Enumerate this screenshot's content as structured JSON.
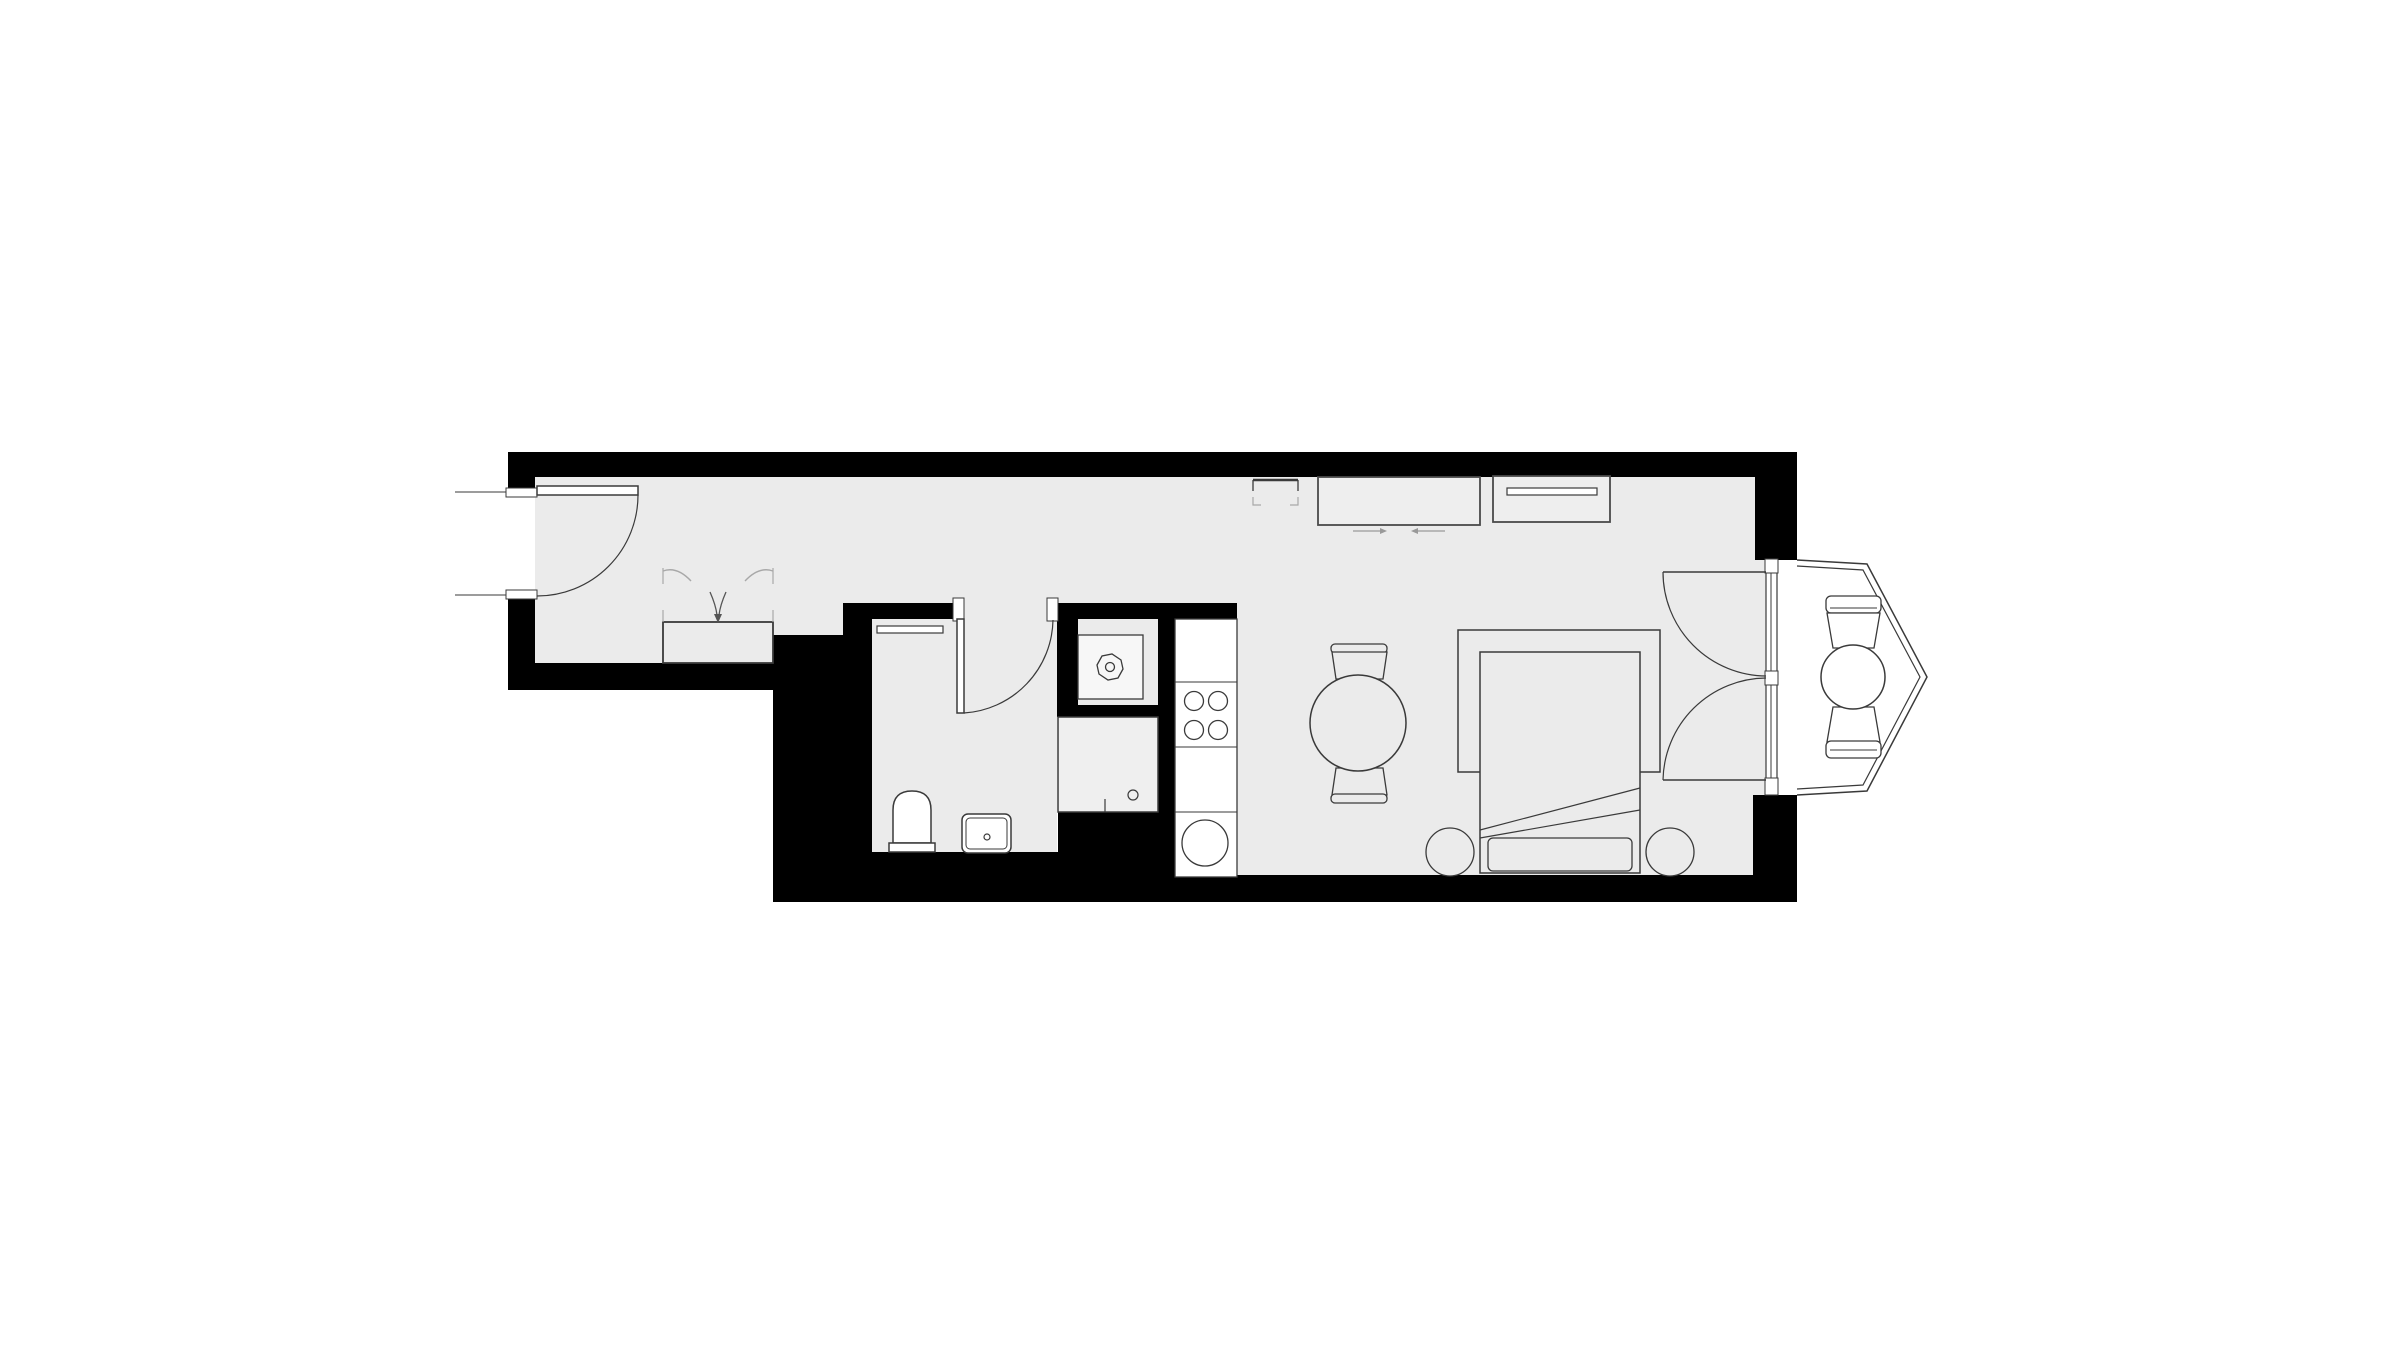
{
  "meta": {
    "title": "apartment-floor-plan",
    "canvas_width": 2400,
    "canvas_height": 1349
  },
  "palette": {
    "background": "#ffffff",
    "floor": "#ebebeb",
    "wall": "#000000",
    "outline": "#3a3a3a",
    "soft": "#555555",
    "light": "#a8a8a8",
    "arrow": "#999999",
    "white": "#ffffff"
  },
  "shapes": [
    {
      "name": "floor-hall-living",
      "type": "polygon",
      "points": "535,477 1755,477 1755,560 1766,560 1766,795 1753,795 1753,875 1237,875 1237,603 843,603 843,635 773,635 773,663 535,663",
      "fill": "floor"
    },
    {
      "name": "floor-bathroom",
      "type": "rect",
      "x": 872,
      "y": 603,
      "w": 185,
      "h": 249,
      "fill": "floor"
    },
    {
      "name": "floor-shower-niche",
      "type": "rect",
      "x": 1078,
      "y": 619,
      "w": 80,
      "h": 86,
      "fill": "floor"
    },
    {
      "name": "floor-bay-balcony",
      "type": "polygon",
      "points": "1776,560 1797,560 1867,564 1927,677 1867,791 1797,795 1776,795",
      "fill": "white"
    },
    {
      "name": "wall-top",
      "type": "rect",
      "x": 508,
      "y": 452,
      "w": 1289,
      "h": 25,
      "fill": "wall"
    },
    {
      "name": "wall-top-right-corner",
      "type": "rect",
      "x": 1755,
      "y": 452,
      "w": 42,
      "h": 108,
      "fill": "wall"
    },
    {
      "name": "wall-left-upper",
      "type": "rect",
      "x": 508,
      "y": 452,
      "w": 27,
      "h": 41,
      "fill": "wall"
    },
    {
      "name": "wall-left-lower",
      "type": "rect",
      "x": 508,
      "y": 597,
      "w": 27,
      "h": 93,
      "fill": "wall"
    },
    {
      "name": "wall-hall-bottom",
      "type": "rect",
      "x": 508,
      "y": 663,
      "w": 265,
      "h": 27,
      "fill": "wall"
    },
    {
      "name": "wall-block-left-of-bath",
      "type": "rect",
      "x": 773,
      "y": 635,
      "w": 70,
      "h": 267,
      "fill": "wall"
    },
    {
      "name": "wall-bath-left",
      "type": "rect",
      "x": 843,
      "y": 603,
      "w": 29,
      "h": 249,
      "fill": "wall"
    },
    {
      "name": "wall-bath-top-left",
      "type": "rect",
      "x": 843,
      "y": 603,
      "w": 113,
      "h": 16,
      "fill": "wall"
    },
    {
      "name": "wall-bath-top-right",
      "type": "rect",
      "x": 1056,
      "y": 603,
      "w": 181,
      "h": 16,
      "fill": "wall"
    },
    {
      "name": "wall-shower-left",
      "type": "rect",
      "x": 1057,
      "y": 619,
      "w": 21,
      "h": 86,
      "fill": "wall"
    },
    {
      "name": "wall-shower-stub",
      "type": "rect",
      "x": 1057,
      "y": 705,
      "w": 101,
      "h": 12,
      "fill": "wall"
    },
    {
      "name": "wall-divider-kitchen",
      "type": "rect",
      "x": 1158,
      "y": 603,
      "w": 17,
      "h": 299,
      "fill": "wall"
    },
    {
      "name": "wall-bath-bottom",
      "type": "rect",
      "x": 843,
      "y": 852,
      "w": 332,
      "h": 50,
      "fill": "wall"
    },
    {
      "name": "wall-below-washing",
      "type": "rect",
      "x": 1058,
      "y": 812,
      "w": 100,
      "h": 40,
      "fill": "wall"
    },
    {
      "name": "wall-bottom",
      "type": "rect",
      "x": 1175,
      "y": 875,
      "w": 578,
      "h": 27,
      "fill": "wall"
    },
    {
      "name": "wall-right-column",
      "type": "rect",
      "x": 1753,
      "y": 795,
      "w": 44,
      "h": 107,
      "fill": "wall"
    },
    {
      "name": "entrance-jamb-top",
      "type": "rect",
      "x": 506,
      "y": 488,
      "w": 31,
      "h": 9,
      "fill": "white",
      "stroke": "outline",
      "sw": 1
    },
    {
      "name": "entrance-jamb-bottom",
      "type": "rect",
      "x": 506,
      "y": 590,
      "w": 31,
      "h": 9,
      "fill": "white",
      "stroke": "outline",
      "sw": 1
    },
    {
      "name": "entrance-threshold-top",
      "type": "line",
      "x1": 455,
      "y1": 492,
      "x2": 506,
      "y2": 492,
      "stroke": "outline",
      "sw": 1
    },
    {
      "name": "entrance-threshold-bottom",
      "type": "line",
      "x1": 455,
      "y1": 595,
      "x2": 506,
      "y2": 595,
      "stroke": "outline",
      "sw": 1
    },
    {
      "name": "bathroom-jamb-left",
      "type": "rect",
      "x": 953,
      "y": 598,
      "w": 11,
      "h": 23,
      "fill": "white",
      "stroke": "outline",
      "sw": 1
    },
    {
      "name": "bathroom-jamb-right",
      "type": "rect",
      "x": 1047,
      "y": 598,
      "w": 11,
      "h": 23,
      "fill": "white",
      "stroke": "outline",
      "sw": 1
    },
    {
      "name": "window-wall",
      "type": "rect",
      "x": 1766,
      "y": 559,
      "w": 11,
      "h": 236,
      "fill": "white",
      "stroke": "outline",
      "sw": 1.2
    },
    {
      "name": "window-jamb-top",
      "type": "rect",
      "x": 1765,
      "y": 559,
      "w": 13,
      "h": 14,
      "fill": "white",
      "stroke": "outline",
      "sw": 1
    },
    {
      "name": "window-jamb-mid",
      "type": "rect",
      "x": 1765,
      "y": 671,
      "w": 13,
      "h": 14,
      "fill": "white",
      "stroke": "outline",
      "sw": 1
    },
    {
      "name": "window-jamb-bottom",
      "type": "rect",
      "x": 1765,
      "y": 778,
      "w": 13,
      "h": 17,
      "fill": "white",
      "stroke": "outline",
      "sw": 1
    },
    {
      "name": "glazing-upper",
      "type": "line",
      "x1": 1771,
      "y1": 573,
      "x2": 1771,
      "y2": 671,
      "stroke": "outline",
      "sw": 1
    },
    {
      "name": "glazing-lower",
      "type": "line",
      "x1": 1771,
      "y1": 685,
      "x2": 1771,
      "y2": 778,
      "stroke": "outline",
      "sw": 1
    },
    {
      "name": "bay-window-outer",
      "type": "path",
      "d": "M 1797,560 L 1867,564 L 1927,677 L 1867,791 L 1797,795",
      "stroke": "outline",
      "sw": 1.5
    },
    {
      "name": "bay-window-inner",
      "type": "path",
      "d": "M 1797,566 L 1863,570 L 1920,677 L 1863,785 L 1797,789",
      "stroke": "outline",
      "sw": 1.2
    },
    {
      "name": "entrance-door-leaf",
      "type": "rect",
      "x": 537,
      "y": 486,
      "w": 101,
      "h": 9,
      "fill": "white",
      "stroke": "outline",
      "sw": 1.5
    },
    {
      "name": "entrance-door-swing-arc",
      "type": "path",
      "d": "M 638,495 A 101,101 0 0 1 537,596",
      "stroke": "outline",
      "sw": 1.2
    },
    {
      "name": "bathroom-door-leaf",
      "type": "rect",
      "x": 957,
      "y": 619,
      "w": 7,
      "h": 94,
      "fill": "white",
      "stroke": "outline",
      "sw": 1.5
    },
    {
      "name": "bathroom-door-swing-arc",
      "type": "path",
      "d": "M 964,713 A 95,95 0 0 0 1053,620",
      "stroke": "outline",
      "sw": 1.2
    },
    {
      "name": "french-door-upper-leaf",
      "type": "line",
      "x1": 1663,
      "y1": 572,
      "x2": 1766,
      "y2": 572,
      "stroke": "outline",
      "sw": 1.5
    },
    {
      "name": "french-door-upper-arc",
      "type": "path",
      "d": "M 1663,572 A 104,104 0 0 0 1766,676",
      "stroke": "outline",
      "sw": 1.2
    },
    {
      "name": "french-door-lower-leaf",
      "type": "line",
      "x1": 1663,
      "y1": 780,
      "x2": 1766,
      "y2": 780,
      "stroke": "outline",
      "sw": 1.5
    },
    {
      "name": "french-door-lower-arc",
      "type": "path",
      "d": "M 1663,780 A 104,104 0 0 1 1766,678",
      "stroke": "outline",
      "sw": 1.2
    },
    {
      "name": "wardrobe",
      "type": "rect",
      "x": 663,
      "y": 622,
      "w": 110,
      "h": 41,
      "fill": "floor",
      "stroke": "outline",
      "sw": 1.8
    },
    {
      "name": "wardrobe-tick-left-upper",
      "type": "line",
      "x1": 663,
      "y1": 568,
      "x2": 663,
      "y2": 584,
      "stroke": "light",
      "sw": 1.2
    },
    {
      "name": "wardrobe-tick-right-upper",
      "type": "line",
      "x1": 773,
      "y1": 568,
      "x2": 773,
      "y2": 584,
      "stroke": "light",
      "sw": 1.2
    },
    {
      "name": "wardrobe-door-arc-left",
      "type": "path",
      "d": "M 663,571 Q 677,566 691,581",
      "stroke": "light",
      "sw": 1.4
    },
    {
      "name": "wardrobe-door-arc-right",
      "type": "path",
      "d": "M 773,571 Q 759,566 745,581",
      "stroke": "light",
      "sw": 1.4
    },
    {
      "name": "wardrobe-tick-left-lower",
      "type": "line",
      "x1": 663,
      "y1": 610,
      "x2": 663,
      "y2": 622,
      "stroke": "light",
      "sw": 1.2
    },
    {
      "name": "wardrobe-tick-right-lower",
      "type": "line",
      "x1": 773,
      "y1": 610,
      "x2": 773,
      "y2": 622,
      "stroke": "light",
      "sw": 1.2
    },
    {
      "name": "wardrobe-entry-arrow",
      "type": "path",
      "d": "M 710,592 C 714,601 716,607 717,615 M 726,592 C 722,601 720,607 719,615",
      "stroke": "soft",
      "sw": 1.3
    },
    {
      "name": "wardrobe-entry-arrowhead",
      "type": "polygon",
      "points": "714,614 722,614 718,623",
      "fill": "soft"
    },
    {
      "name": "bath-shelf",
      "type": "rect",
      "x": 877,
      "y": 626,
      "w": 66,
      "h": 7,
      "fill": "white",
      "stroke": "outline",
      "sw": 1.2
    },
    {
      "name": "toilet-bowl",
      "type": "path",
      "d": "M 893,843 L 893,810 Q 893,791 912,791 Q 931,791 931,810 L 931,843 Z",
      "fill": "white",
      "stroke": "outline",
      "sw": 1.5
    },
    {
      "name": "toilet-tank",
      "type": "rect",
      "x": 889,
      "y": 843,
      "w": 46,
      "h": 9,
      "fill": "white",
      "stroke": "outline",
      "sw": 1.5
    },
    {
      "name": "washbasin-outer",
      "type": "rect",
      "x": 962,
      "y": 814,
      "w": 49,
      "h": 39,
      "rx": 6,
      "fill": "white",
      "stroke": "outline",
      "sw": 1.5
    },
    {
      "name": "washbasin-inner",
      "type": "rect",
      "x": 966,
      "y": 818,
      "w": 41,
      "h": 31,
      "rx": 4,
      "stroke": "outline",
      "sw": 1
    },
    {
      "name": "washbasin-drain",
      "type": "circle",
      "cx": 987,
      "cy": 837,
      "r": 3,
      "stroke": "outline",
      "sw": 1.2
    },
    {
      "name": "shower-tray",
      "type": "rect",
      "x": 1078,
      "y": 635,
      "w": 65,
      "h": 64,
      "fill": "#f7f7f7",
      "stroke": "outline",
      "sw": 1.3
    },
    {
      "name": "shower-head-octagon",
      "type": "polygon",
      "points": "1123,669 1118,678 1108,680 1099,674 1097,665 1102,656 1112,654 1121,660",
      "stroke": "outline",
      "sw": 1.3
    },
    {
      "name": "shower-head-center",
      "type": "circle",
      "cx": 1110,
      "cy": 667,
      "r": 4.5,
      "stroke": "outline",
      "sw": 1.3
    },
    {
      "name": "washing-machine",
      "type": "rect",
      "x": 1058,
      "y": 717,
      "w": 100,
      "h": 95,
      "fill": "#efefef",
      "stroke": "outline",
      "sw": 1.5
    },
    {
      "name": "washing-machine-knob",
      "type": "circle",
      "cx": 1133,
      "cy": 795,
      "r": 5,
      "stroke": "outline",
      "sw": 1.2
    },
    {
      "name": "washing-machine-tick",
      "type": "line",
      "x1": 1105,
      "y1": 799,
      "x2": 1105,
      "y2": 812,
      "stroke": "outline",
      "sw": 1.2
    },
    {
      "name": "kitchen-counter",
      "type": "rect",
      "x": 1175,
      "y": 619,
      "w": 62,
      "h": 258,
      "fill": "white",
      "stroke": "outline",
      "sw": 1.3
    },
    {
      "name": "counter-divider-1",
      "type": "line",
      "x1": 1175,
      "y1": 682,
      "x2": 1237,
      "y2": 682,
      "stroke": "outline",
      "sw": 1
    },
    {
      "name": "counter-divider-2",
      "type": "line",
      "x1": 1175,
      "y1": 747,
      "x2": 1237,
      "y2": 747,
      "stroke": "outline",
      "sw": 1
    },
    {
      "name": "counter-divider-3",
      "type": "line",
      "x1": 1175,
      "y1": 812,
      "x2": 1237,
      "y2": 812,
      "stroke": "outline",
      "sw": 1
    },
    {
      "name": "stove-burner-1",
      "type": "circle",
      "cx": 1194,
      "cy": 701,
      "r": 9.5,
      "stroke": "outline",
      "sw": 1.3
    },
    {
      "name": "stove-burner-2",
      "type": "circle",
      "cx": 1218,
      "cy": 701,
      "r": 9.5,
      "stroke": "outline",
      "sw": 1.3
    },
    {
      "name": "stove-burner-3",
      "type": "circle",
      "cx": 1194,
      "cy": 730,
      "r": 9.5,
      "stroke": "outline",
      "sw": 1.3
    },
    {
      "name": "stove-burner-4",
      "type": "circle",
      "cx": 1218,
      "cy": 730,
      "r": 9.5,
      "stroke": "outline",
      "sw": 1.3
    },
    {
      "name": "kitchen-sink",
      "type": "circle",
      "cx": 1205,
      "cy": 843,
      "r": 23,
      "stroke": "outline",
      "sw": 1.3
    },
    {
      "name": "corner-unit-top",
      "type": "line",
      "x1": 1253,
      "y1": 480,
      "x2": 1298,
      "y2": 480,
      "stroke": "outline",
      "sw": 2.5
    },
    {
      "name": "corner-unit-left",
      "type": "line",
      "x1": 1253,
      "y1": 480,
      "x2": 1253,
      "y2": 491,
      "stroke": "outline",
      "sw": 1.3
    },
    {
      "name": "corner-unit-right",
      "type": "line",
      "x1": 1298,
      "y1": 480,
      "x2": 1298,
      "y2": 491,
      "stroke": "outline",
      "sw": 1.3
    },
    {
      "name": "corner-unit-dash-left",
      "type": "path",
      "d": "M 1253,497 L 1253,505 L 1261,505",
      "stroke": "light",
      "sw": 1.2
    },
    {
      "name": "corner-unit-dash-right",
      "type": "path",
      "d": "M 1290,505 L 1298,505 L 1298,497",
      "stroke": "light",
      "sw": 1.2
    },
    {
      "name": "sideboard",
      "type": "rect",
      "x": 1318,
      "y": 477,
      "w": 162,
      "h": 48,
      "fill": "#eeeeee",
      "stroke": "#4a4a4a",
      "sw": 1.8
    },
    {
      "name": "sliding-arrow-right",
      "type": "line",
      "x1": 1353,
      "y1": 531,
      "x2": 1380,
      "y2": 531,
      "stroke": "arrow",
      "sw": 1.3
    },
    {
      "name": "sliding-arrow-right-head",
      "type": "polygon",
      "points": "1380,528 1387,531 1380,534",
      "fill": "arrow"
    },
    {
      "name": "sliding-arrow-left",
      "type": "line",
      "x1": 1418,
      "y1": 531,
      "x2": 1445,
      "y2": 531,
      "stroke": "arrow",
      "sw": 1.3
    },
    {
      "name": "sliding-arrow-left-head",
      "type": "polygon",
      "points": "1418,528 1411,531 1418,534",
      "fill": "arrow"
    },
    {
      "name": "tv-stand",
      "type": "rect",
      "x": 1493,
      "y": 476,
      "w": 117,
      "h": 46,
      "fill": "#eeeeee",
      "stroke": "#4a4a4a",
      "sw": 1.8
    },
    {
      "name": "tv",
      "type": "rect",
      "x": 1507,
      "y": 488,
      "w": 90,
      "h": 7,
      "fill": "white",
      "stroke": "outline",
      "sw": 1.2
    },
    {
      "name": "dining-chair-top-backrest",
      "type": "rect",
      "x": 1331,
      "y": 644,
      "w": 56,
      "h": 9,
      "rx": 4,
      "fill": "floor",
      "stroke": "outline",
      "sw": 1.3
    },
    {
      "name": "dining-chair-top-seat",
      "type": "polygon",
      "points": "1332,652 1387,652 1383,679 1336,679",
      "fill": "floor",
      "stroke": "outline",
      "sw": 1.3
    },
    {
      "name": "dining-chair-bottom-seat",
      "type": "polygon",
      "points": "1336,768 1383,768 1387,795 1332,795",
      "fill": "floor",
      "stroke": "outline",
      "sw": 1.3
    },
    {
      "name": "dining-chair-bottom-backrest",
      "type": "rect",
      "x": 1331,
      "y": 794,
      "w": 56,
      "h": 9,
      "rx": 4,
      "fill": "floor",
      "stroke": "outline",
      "sw": 1.3
    },
    {
      "name": "dining-table",
      "type": "circle",
      "cx": 1358,
      "cy": 723,
      "r": 48,
      "fill": "floor",
      "stroke": "outline",
      "sw": 1.5
    },
    {
      "name": "bed-frame",
      "type": "path",
      "d": "M 1480,772 L 1458,772 L 1458,630 L 1660,630 L 1660,772 L 1640,772",
      "stroke": "outline",
      "sw": 1.5
    },
    {
      "name": "bed-mattress",
      "type": "rect",
      "x": 1480,
      "y": 652,
      "w": 160,
      "h": 221,
      "fill": "floor",
      "stroke": "outline",
      "sw": 1.5
    },
    {
      "name": "blanket-fold-1",
      "type": "line",
      "x1": 1480,
      "y1": 830,
      "x2": 1640,
      "y2": 788,
      "stroke": "outline",
      "sw": 1.2
    },
    {
      "name": "blanket-fold-2",
      "type": "line",
      "x1": 1480,
      "y1": 838,
      "x2": 1640,
      "y2": 810,
      "stroke": "outline",
      "sw": 1.2
    },
    {
      "name": "pillow",
      "type": "rect",
      "x": 1488,
      "y": 838,
      "w": 144,
      "h": 33,
      "rx": 5,
      "fill": "floor",
      "stroke": "outline",
      "sw": 1.3
    },
    {
      "name": "nightstand-left",
      "type": "circle",
      "cx": 1450,
      "cy": 852,
      "r": 24,
      "fill": "floor",
      "stroke": "outline",
      "sw": 1.3
    },
    {
      "name": "nightstand-right",
      "type": "circle",
      "cx": 1670,
      "cy": 852,
      "r": 24,
      "fill": "floor",
      "stroke": "outline",
      "sw": 1.3
    },
    {
      "name": "balcony-chair-top-backrest",
      "type": "rect",
      "x": 1826,
      "y": 596,
      "w": 55,
      "h": 17,
      "rx": 5,
      "fill": "white",
      "stroke": "outline",
      "sw": 1.3
    },
    {
      "name": "balcony-chair-top-backline",
      "type": "line",
      "x1": 1830,
      "y1": 608,
      "x2": 1877,
      "y2": 608,
      "stroke": "outline",
      "sw": 1
    },
    {
      "name": "balcony-chair-top-seat",
      "type": "polygon",
      "points": "1827,613 1880,613 1874,648 1833,648",
      "fill": "white",
      "stroke": "outline",
      "sw": 1.3
    },
    {
      "name": "balcony-chair-bottom-seat",
      "type": "polygon",
      "points": "1833,707 1874,707 1880,742 1827,742",
      "fill": "white",
      "stroke": "outline",
      "sw": 1.3
    },
    {
      "name": "balcony-chair-bottom-backrest",
      "type": "rect",
      "x": 1826,
      "y": 741,
      "w": 55,
      "h": 17,
      "rx": 5,
      "fill": "white",
      "stroke": "outline",
      "sw": 1.3
    },
    {
      "name": "balcony-chair-bottom-backline",
      "type": "line",
      "x1": 1830,
      "y1": 750,
      "x2": 1877,
      "y2": 750,
      "stroke": "outline",
      "sw": 1
    },
    {
      "name": "balcony-table",
      "type": "circle",
      "cx": 1853,
      "cy": 677,
      "r": 32,
      "fill": "white",
      "stroke": "outline",
      "sw": 1.5
    }
  ]
}
